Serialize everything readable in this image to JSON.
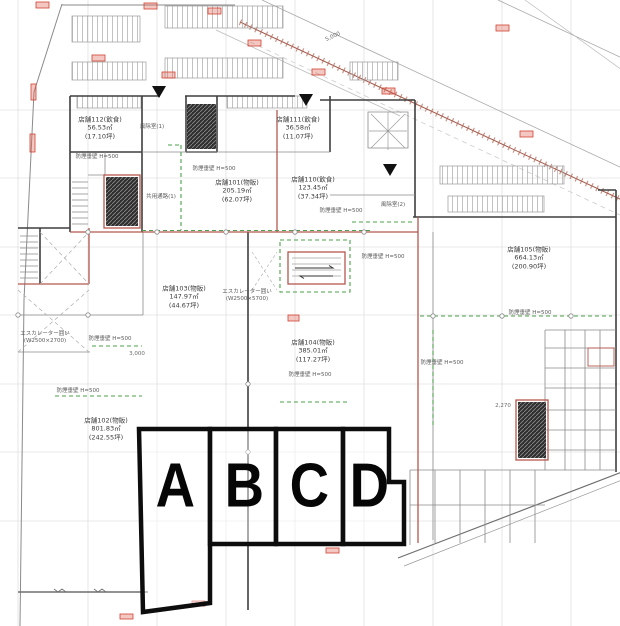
{
  "drawing": {
    "kind": "retail-floor-plan",
    "zone_note": "A B C D section overlay"
  },
  "colors": {
    "wall": "#3f3f3f",
    "red_wall": "#b5574d",
    "smoke_barrier_green": "#4aa04a",
    "zone_outline": "#0d0d0d",
    "grid": "#cfcfcf",
    "marker_red": "#d04030"
  },
  "zones": [
    {
      "label": "A",
      "x": 174,
      "y": 489
    },
    {
      "label": "B",
      "x": 243,
      "y": 489
    },
    {
      "label": "C",
      "x": 308,
      "y": 489
    },
    {
      "label": "D",
      "x": 368,
      "y": 489
    }
  ],
  "stores": [
    {
      "name": "店舗112(飲食)",
      "m2": "56.53㎡",
      "tsubo": "(17.10坪)",
      "x": 100,
      "y": 128
    },
    {
      "name": "店舗111(飲食)",
      "m2": "36.58㎡",
      "tsubo": "(11.07坪)",
      "x": 298,
      "y": 128
    },
    {
      "name": "店舗101(物販)",
      "m2": "205.19㎡",
      "tsubo": "(62.07坪)",
      "x": 237,
      "y": 191
    },
    {
      "name": "店舗110(飲食)",
      "m2": "123.45㎡",
      "tsubo": "(37.34坪)",
      "x": 313,
      "y": 188
    },
    {
      "name": "店舗105(物販)",
      "m2": "664.13㎡",
      "tsubo": "(200.90坪)",
      "x": 529,
      "y": 258
    },
    {
      "name": "店舗103(物販)",
      "m2": "147.97㎡",
      "tsubo": "(44.67坪)",
      "x": 184,
      "y": 297
    },
    {
      "name": "店舗104(物販)",
      "m2": "385.01㎡",
      "tsubo": "(117.27坪)",
      "x": 313,
      "y": 351
    },
    {
      "name": "店舗102(物販)",
      "m2": "801.83㎡",
      "tsubo": "(242.55坪)",
      "x": 106,
      "y": 429
    }
  ],
  "annotations": [
    {
      "text": "防煙垂壁 H=500",
      "x": 97,
      "y": 156
    },
    {
      "text": "防煙垂壁 H=500",
      "x": 214,
      "y": 168
    },
    {
      "text": "防煙垂壁 H=500",
      "x": 341,
      "y": 210
    },
    {
      "text": "防煙垂壁 H=500",
      "x": 383,
      "y": 256
    },
    {
      "text": "防煙垂壁 H=500",
      "x": 310,
      "y": 374
    },
    {
      "text": "防煙垂壁 H=500",
      "x": 442,
      "y": 362
    },
    {
      "text": "防煙垂壁 H=500",
      "x": 530,
      "y": 312
    },
    {
      "text": "防煙垂壁 H=500",
      "x": 110,
      "y": 338
    },
    {
      "text": "防煙垂壁 H=500",
      "x": 78,
      "y": 390
    },
    {
      "text": "風除室(1)",
      "x": 152,
      "y": 126
    },
    {
      "text": "風除室(2)",
      "x": 393,
      "y": 204
    },
    {
      "text": "共用通路(1)",
      "x": 161,
      "y": 196
    },
    {
      "text": "エスカレーター囲い",
      "x": 247,
      "y": 291
    },
    {
      "text": "(W2500×5700)",
      "x": 247,
      "y": 299
    },
    {
      "text": "エスカレーター囲い",
      "x": 45,
      "y": 333
    },
    {
      "text": "(W2500×2700)",
      "x": 45,
      "y": 341
    }
  ],
  "dimensions": [
    {
      "text": "5,000",
      "x": 333,
      "y": 37,
      "rotate": -24
    },
    {
      "text": "3,000",
      "x": 137,
      "y": 354,
      "rotate": 0
    },
    {
      "text": "2,270",
      "x": 503,
      "y": 406,
      "rotate": 0
    }
  ]
}
